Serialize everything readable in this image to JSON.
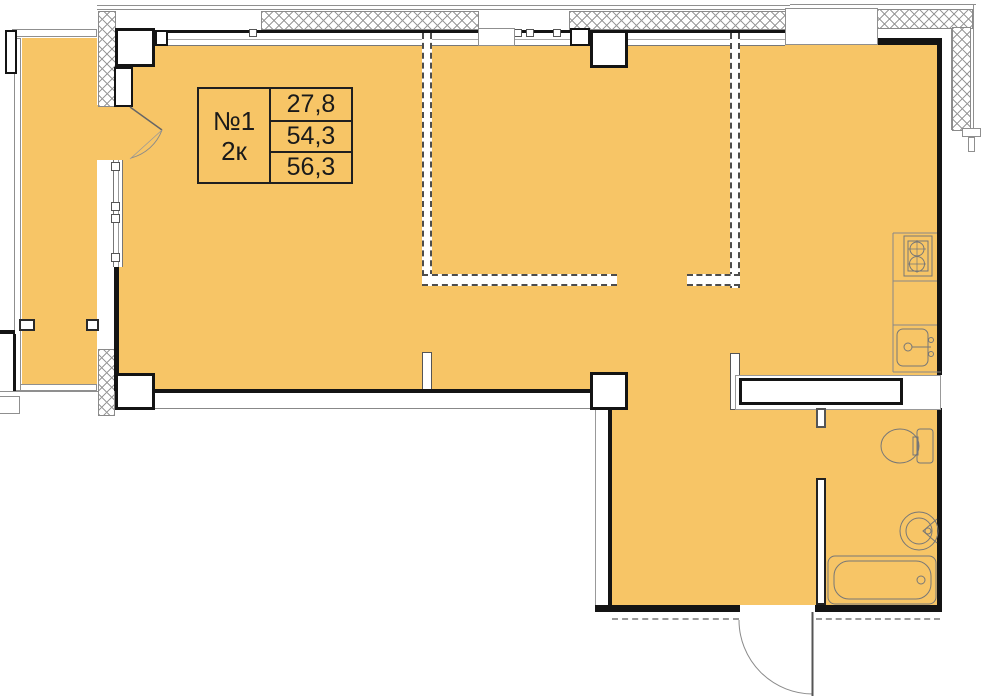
{
  "floor_plan": {
    "unit": {
      "number": "№1",
      "type": "2к",
      "areas": [
        "27,8",
        "54,3",
        "56,3"
      ]
    },
    "fixtures": {
      "kitchen": [
        "stove-icon",
        "kitchen-sink-icon"
      ],
      "bathroom": [
        "toilet-icon",
        "washbasin-icon",
        "bathtub-icon"
      ]
    },
    "colors": {
      "floor": "#F7C566",
      "wall": "#141414",
      "partition_dash": "#4D4D4D",
      "outline": "#8F8F8F"
    }
  }
}
